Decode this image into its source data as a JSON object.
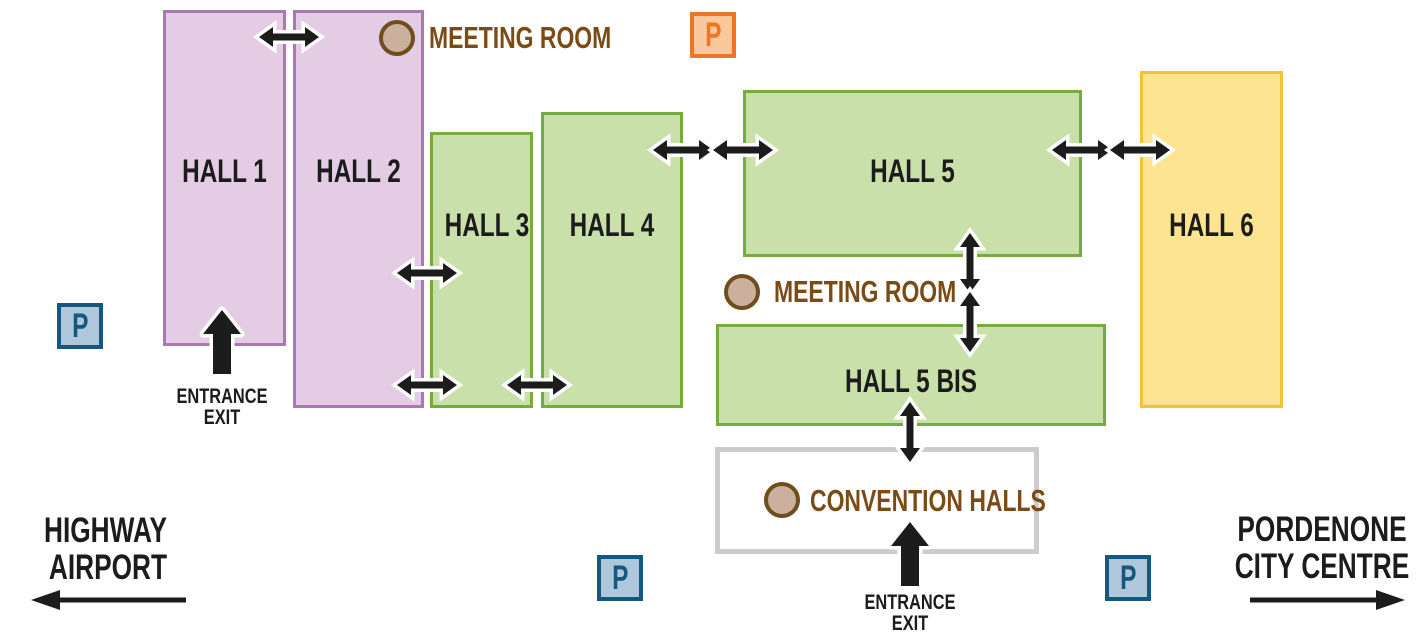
{
  "palette": {
    "purple_fill": "#e3cce4",
    "purple_border": "#a97ab1",
    "green_fill": "#c9e0ab",
    "green_border": "#76ab3e",
    "yellow_fill": "#fce491",
    "yellow_border": "#f4c235",
    "blue_parking_fill": "#afc7da",
    "blue_parking_border": "#15587f",
    "orange_parking_fill": "#fbc89c",
    "orange_parking_border": "#ee7426",
    "meeting_fill": "#cbb09e",
    "meeting_border": "#6f4e1d",
    "brown_text": "#7b4a15",
    "gray_border": "#cccccc",
    "black": "#1c1c1c"
  },
  "halls": [
    {
      "label": "HALL 1",
      "color": "purple"
    },
    {
      "label": "HALL 2",
      "color": "purple"
    },
    {
      "label": "HALL 3",
      "color": "green"
    },
    {
      "label": "HALL 4",
      "color": "green"
    },
    {
      "label": "HALL 5",
      "color": "green"
    },
    {
      "label": "HALL 5 BIS",
      "color": "green"
    },
    {
      "label": "HALL 6",
      "color": "yellow"
    }
  ],
  "parking": {
    "label": "P"
  },
  "markers": {
    "meeting_room_top": {
      "label": "MEETING ROOM"
    },
    "meeting_room_middle": {
      "label": "MEETING ROOM"
    },
    "convention_halls": {
      "label": "CONVENTION HALLS"
    }
  },
  "entrances": {
    "hall1": {
      "line1": "ENTRANCE",
      "line2": "EXIT"
    },
    "convention": {
      "line1": "ENTRANCE",
      "line2": "EXIT"
    }
  },
  "directions": {
    "left": {
      "line1": "HIGHWAY",
      "line2": "AIRPORT"
    },
    "right": {
      "line1": "PORDENONE",
      "line2": "CITY CENTRE"
    }
  }
}
